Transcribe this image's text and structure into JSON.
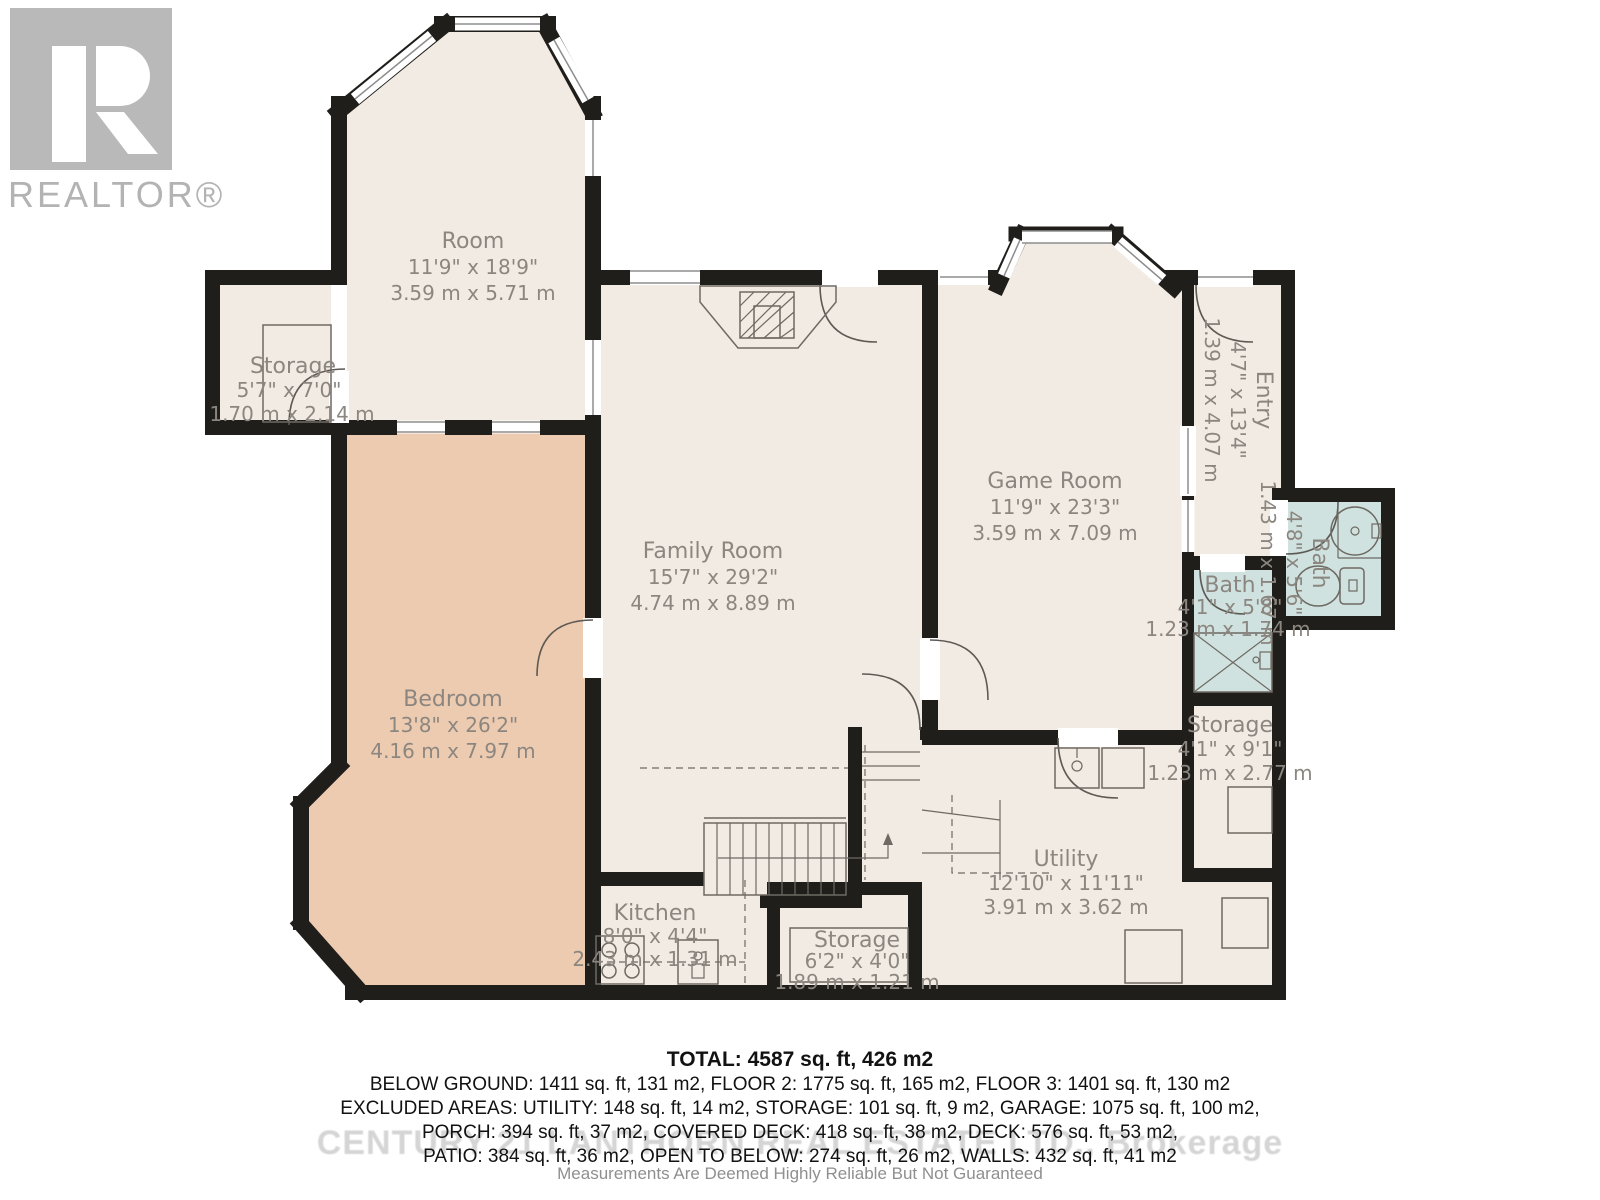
{
  "logo": {
    "brand": "REALTOR®"
  },
  "colors": {
    "wall": "#201e1b",
    "room_fill": "#f2ebe3",
    "bedroom_fill": "#edcbb0",
    "bath_fill": "#cfe2df",
    "label": "#8c8680"
  },
  "rooms": [
    {
      "id": "room",
      "name": "Room",
      "imperial": "11'9\" x 18'9\"",
      "metric": "3.59 m x 5.71 m"
    },
    {
      "id": "storage-left",
      "name": "Storage",
      "imperial": "5'7\" x 7'0\"",
      "metric": "1.70 m x 2.14 m"
    },
    {
      "id": "bedroom",
      "name": "Bedroom",
      "imperial": "13'8\" x 26'2\"",
      "metric": "4.16 m x 7.97 m"
    },
    {
      "id": "family-room",
      "name": "Family Room",
      "imperial": "15'7\" x 29'2\"",
      "metric": "4.74 m x 8.89 m"
    },
    {
      "id": "game-room",
      "name": "Game Room",
      "imperial": "11'9\" x 23'3\"",
      "metric": "3.59 m x 7.09 m"
    },
    {
      "id": "entry",
      "name": "Entry",
      "imperial": "4'7\" x 13'4\"",
      "metric": "1.39 m x 4.07 m"
    },
    {
      "id": "bath-right",
      "name": "Bath",
      "imperial": "4'8\" x 5'6\"",
      "metric": "1.43 m x 1.67 m"
    },
    {
      "id": "bath-left",
      "name": "Bath",
      "imperial": "4'1\" x 5'8\"",
      "metric": "1.23 m x 1.74 m"
    },
    {
      "id": "storage-right",
      "name": "Storage",
      "imperial": "4'1\" x 9'1\"",
      "metric": "1.23 m x 2.77 m"
    },
    {
      "id": "utility",
      "name": "Utility",
      "imperial": "12'10\" x 11'11\"",
      "metric": "3.91 m x 3.62 m"
    },
    {
      "id": "kitchen",
      "name": "Kitchen",
      "imperial": "8'0\" x 4'4\"",
      "metric": "2.43 m x 1.31 m"
    },
    {
      "id": "storage-bottom",
      "name": "Storage",
      "imperial": "6'2\" x 4'0\"",
      "metric": "1.89 m x 1.21 m"
    }
  ],
  "summary": {
    "total": "TOTAL: 4587 sq. ft, 426 m2",
    "line1": "BELOW GROUND: 1411 sq. ft, 131 m2, FLOOR 2: 1775 sq. ft, 165 m2, FLOOR 3: 1401 sq. ft, 130 m2",
    "line2": "EXCLUDED AREAS: UTILITY: 148 sq. ft, 14 m2, STORAGE: 101 sq. ft, 9 m2, GARAGE: 1075 sq. ft, 100 m2,",
    "line3": "PORCH: 394 sq. ft, 37 m2, COVERED DECK: 418 sq. ft, 38 m2, DECK: 576 sq. ft, 53 m2,",
    "line4": "PATIO: 384 sq. ft, 36 m2, OPEN TO BELOW: 274 sq. ft, 26 m2, WALLS: 432 sq. ft, 41 m2"
  },
  "watermark": "CENTURY 21 LANTHORN REAL ESTATE LTD., Brokerage",
  "disclaimer": "Measurements Are Deemed Highly Reliable But Not Guaranteed"
}
